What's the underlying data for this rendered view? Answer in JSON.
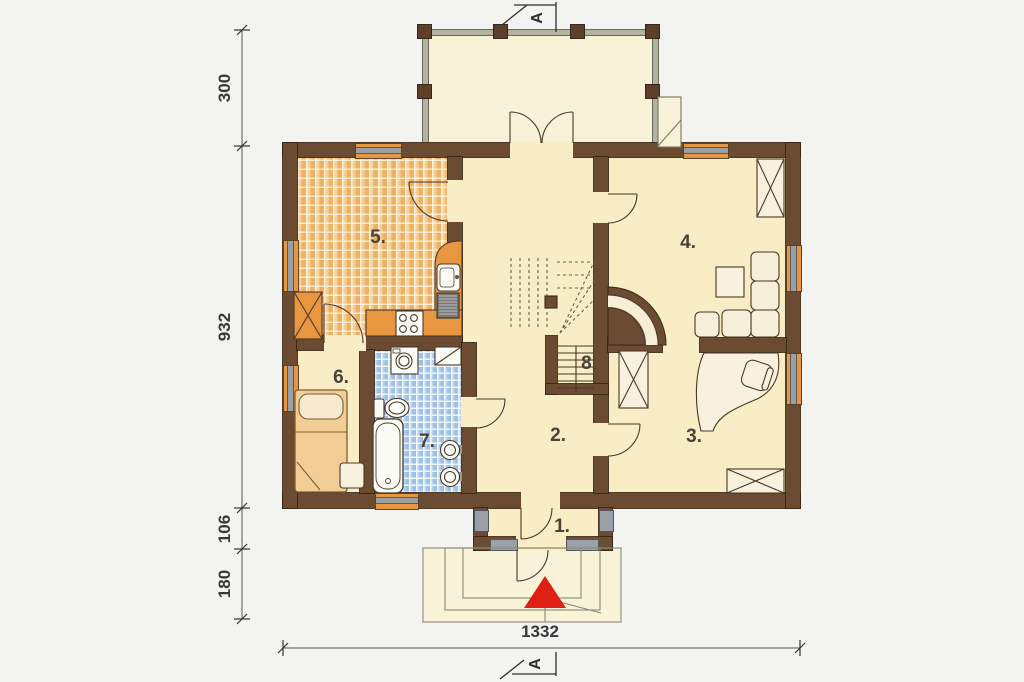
{
  "section": {
    "letter": "A"
  },
  "rooms": {
    "r1": {
      "label": "1."
    },
    "r2": {
      "label": "2."
    },
    "r3": {
      "label": "3."
    },
    "r4": {
      "label": "4."
    },
    "r5": {
      "label": "5."
    },
    "r6": {
      "label": "6."
    },
    "r7": {
      "label": "7."
    },
    "r8": {
      "label": "8."
    }
  },
  "dimensions": {
    "left": [
      {
        "value": "300"
      },
      {
        "value": "932"
      },
      {
        "value": "106"
      },
      {
        "value": "180"
      }
    ],
    "bottom": {
      "value": "1332"
    }
  },
  "colors": {
    "wall": "#6b4b31",
    "wall_outline": "#3e2a19",
    "floor": "#f8edc5",
    "terrace_floor": "#f7f2d8",
    "kitchen_tile": "#f2bf7e",
    "bath_tile": "#a6c6e8",
    "window_frame": "#e8963f",
    "window_glass": "#9aa0a8",
    "entrance_arrow": "#df1f14"
  },
  "fixtures": {
    "kitchen": [
      "kitchen-counter",
      "kitchen-sink",
      "fridge",
      "stove",
      "chimney-flue"
    ],
    "bathroom": [
      "washing-machine",
      "shelf",
      "toilet",
      "bathtub",
      "washbasin"
    ],
    "bedroom": [
      "bed",
      "nightstand"
    ],
    "living_room": [
      "corner-sofa",
      "coffee-table",
      "chimney-flue"
    ],
    "office": [
      "desk",
      "office-chair",
      "wardrobe",
      "chimney-flue"
    ],
    "hall": [
      "winder-staircase",
      "arched-passage"
    ],
    "entrance": [
      "entrance-steps",
      "entrance-arrow"
    ]
  }
}
